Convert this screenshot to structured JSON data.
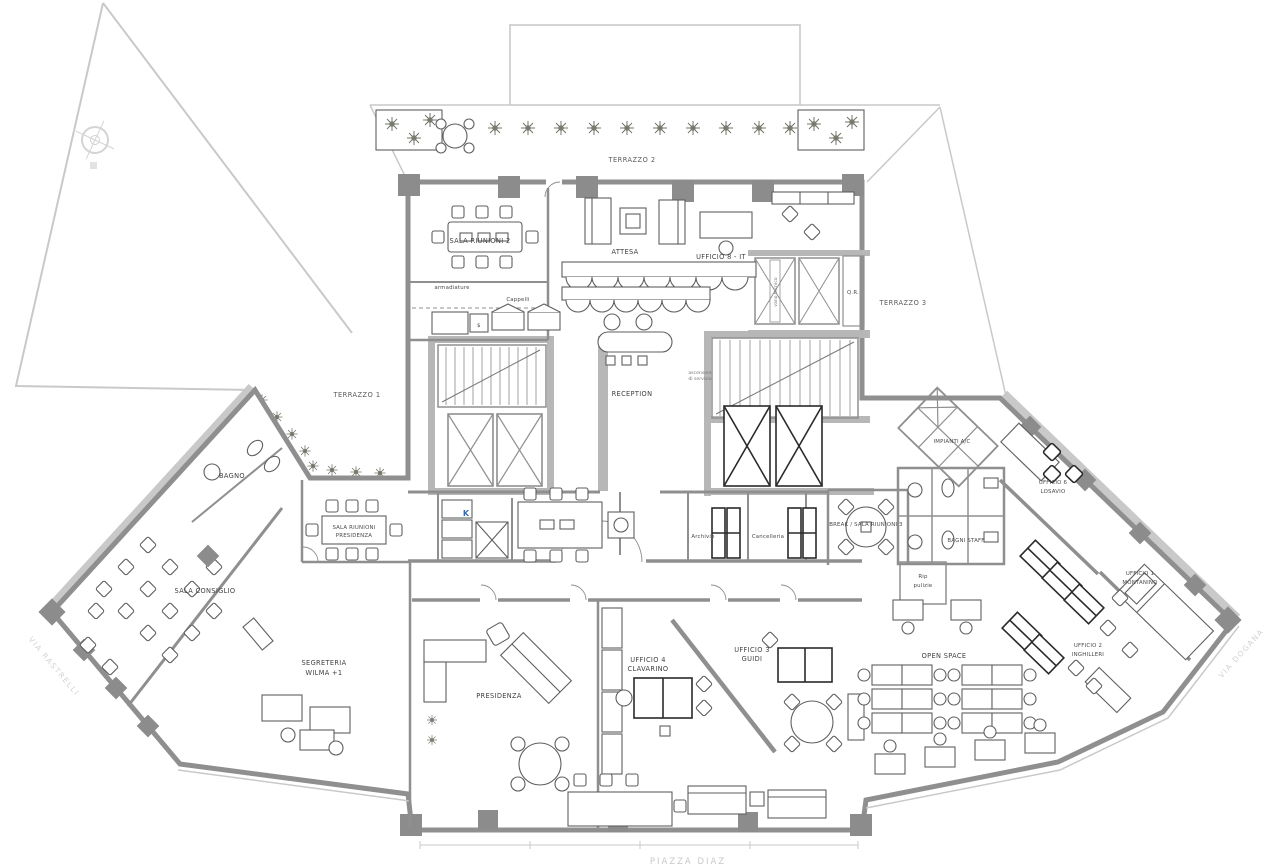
{
  "plan": {
    "streets": {
      "bottom": "PIAZZA DIAZ",
      "left": "VIA RASTRELLI",
      "right": "VIA DOGANA"
    },
    "terraces": {
      "t1": "TERRAZZO 1",
      "t2": "TERRAZZO 2",
      "t3": "TERRAZZO 3"
    },
    "rooms": {
      "sala_riunioni_2": "SALA RIUNIONI 2",
      "attesa": "ATTESA",
      "ufficio_8": "UFFICIO 8 - IT",
      "qr": "Q.R.",
      "vano_tecnico": "vano tecnico",
      "reception": "RECEPTION",
      "asc_l1": "ascensore",
      "asc_l2": "di servizio",
      "armadiature": "armadiature",
      "cappelli": "Cappelli",
      "s_box": "$",
      "kitchen": "K",
      "bagno": "BAGNO",
      "srp_l1": "SALA RIUNIONI",
      "srp_l2": "PRESIDENZA",
      "sala_consiglio": "SALA CONSIGLIO",
      "segreteria_l1": "SEGRETERIA",
      "segreteria_l2": "WILMA +1",
      "presidenza": "PRESIDENZA",
      "ufficio_4_l1": "UFFICIO 4",
      "ufficio_4_l2": "CLAVARINO",
      "ufficio_3_l1": "UFFICIO 3",
      "ufficio_3_l2": "GUIDI",
      "break_room": "BREAK / SALA RIUNIONI 3",
      "archivio": "Archivio",
      "cancelleria": "Cancelleria",
      "bagni_staff": "BAGNI STAFF",
      "rip_l1": "Rip",
      "rip_l2": "pulizie",
      "impianti": "IMPIANTI A/C",
      "ufficio_6_l1": "UFFICIO 6",
      "ufficio_6_l2": "LOSAVIO",
      "ufficio_1_l1": "UFFICIO 1",
      "ufficio_1_l2": "MONTANINO",
      "ufficio_2_l1": "UFFICIO 2",
      "ufficio_2_l2": "INGHILLERI",
      "open_space": "OPEN SPACE"
    },
    "icons": {
      "compass": "compass-rose"
    },
    "colors": {
      "wall": "#8f8f8f",
      "poche": "#b7b7b7",
      "context": "#c9c9c9",
      "label": "#3f3f3f",
      "faint": "#d0d0d0",
      "plant": "#72776a",
      "accent_blue": "#2f6db5"
    }
  }
}
